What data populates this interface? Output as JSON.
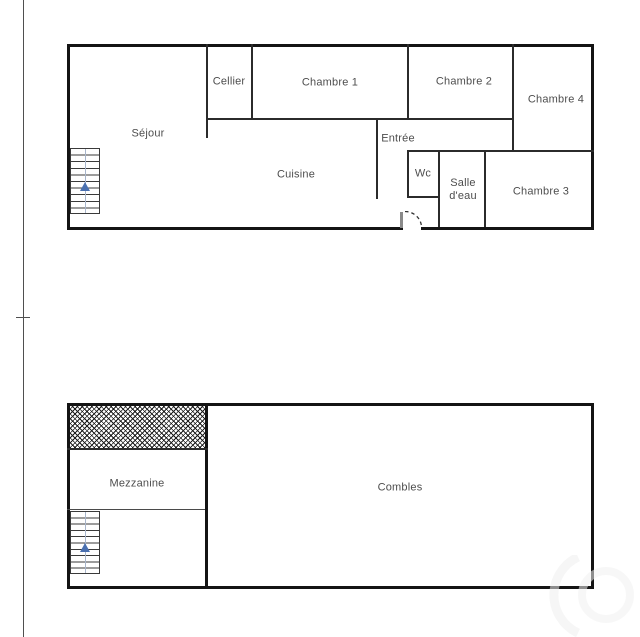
{
  "document": {
    "type": "floor-plan",
    "levels": 2
  },
  "floor1": {
    "rooms": {
      "sejour": "Séjour",
      "cellier": "Cellier",
      "chambre1": "Chambre 1",
      "chambre2": "Chambre 2",
      "chambre4": "Chambre 4",
      "entree": "Entrée",
      "cuisine": "Cuisine",
      "wc": "Wc",
      "salle_deau": "Salle d'eau",
      "chambre3": "Chambre 3"
    }
  },
  "floor2": {
    "rooms": {
      "mezzanine": "Mezzanine",
      "combles": "Combles"
    }
  },
  "icons": {
    "stairs_up_arrow": "triangle-up",
    "door_swing": "dashed-quarter-arc",
    "void_area": "cross-hatch"
  },
  "colors": {
    "background": "#ffffff",
    "wall": "#141414",
    "label_text": "#4d4d4d",
    "stairs_arrow_blue": "#4a70b0",
    "stairs_center_line": "#a9b6cb",
    "frame_line": "#4f4f4f"
  }
}
